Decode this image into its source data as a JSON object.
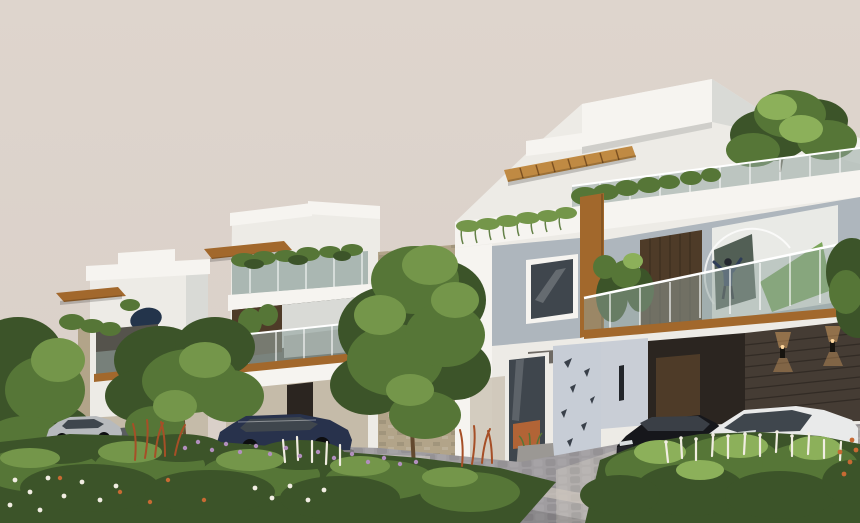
{
  "scene": {
    "type": "3d-architectural-render",
    "subject": "Row of three modern white duplex villas with balconies, wooden accents, landscaped street",
    "villa_count": 3,
    "vehicles": [
      "silver-sedan",
      "navy-sedan",
      "black-sedan",
      "white-sedan"
    ],
    "figures": [
      "person-on-balcony"
    ]
  },
  "palette": {
    "sky": "#d9cfc8",
    "sky_top": "#ded5cd",
    "white_lit": "#f6f4f0",
    "white_soft": "#edebe6",
    "white_shade": "#d9dad6",
    "white_cool": "#c9ced6",
    "grey_wall": "#aeb6bd",
    "panel_grey": "#c7cdd6",
    "soffit_dark": "#6e6a64",
    "fascia_edge": "#c2c2be",
    "wood": "#a2682c",
    "wood_light": "#c08a43",
    "wood_dark": "#7c5122",
    "door_wood": "#4e3b28",
    "glass": "#93a5a0",
    "window_dark": "#3f464d",
    "interior_dark": "#2b2520",
    "stone_dark": "#453c34",
    "stone_line": "#322b25",
    "stone_beige": "#b2a489",
    "beige_wall": "#c5bba9",
    "green_dark": "#3c5429",
    "green_mid": "#567637",
    "green_light": "#74964a",
    "green_bright": "#8cb05a",
    "trunk": "#63492f",
    "flower_white": "#f1ede2",
    "flower_purple": "#b28fbe",
    "flower_rust": "#a64f27",
    "flower_orange": "#c76a33",
    "road": "#a09da0",
    "road_light": "#b6b2af",
    "curb": "#cfc8bf",
    "car_black": "#16171b",
    "car_white": "#e9eaea",
    "car_white_shade": "#bfc3c6",
    "car_silver": "#b7babd",
    "car_navy": "#28324c",
    "wheel": "#0d0e10",
    "rim": "#8e9296",
    "chrome": "#d8dcdf",
    "glow": "#f0b169",
    "person_navy": "#2f3d58",
    "person_dark": "#23262e",
    "mural_bg": "#e9eae6",
    "mural_green": "#6f9e4a",
    "mural_dark": "#37463b",
    "satellite": "#23344b",
    "shadow": "#00000040"
  }
}
